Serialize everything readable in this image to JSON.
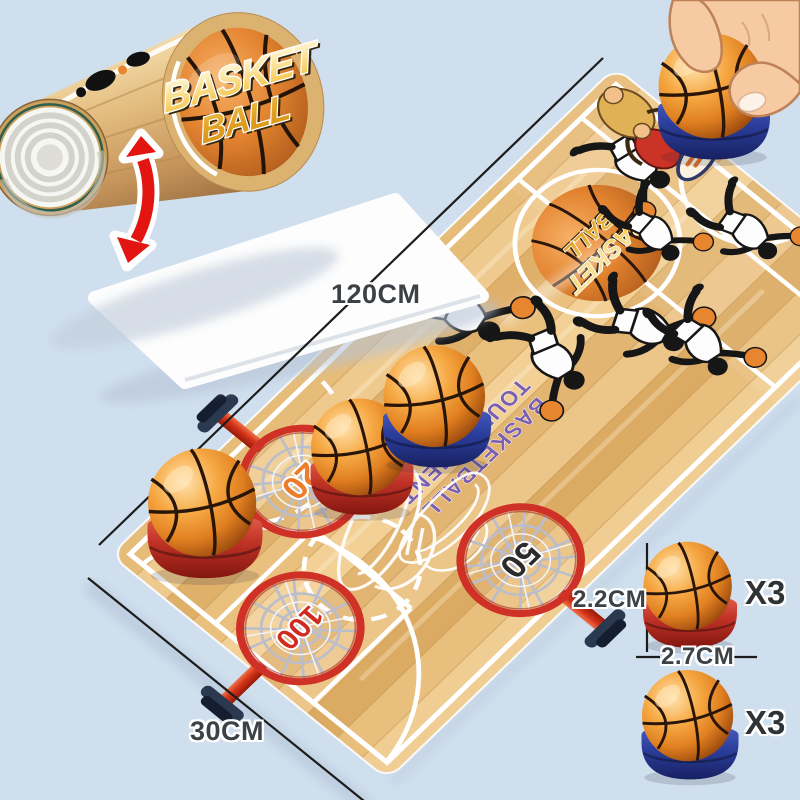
{
  "product_name": "basketball tabletop flick game mat",
  "rolled_mat": {
    "logo_line1": "BASKET",
    "logo_line2": "BALL"
  },
  "court": {
    "center_logo_line1": "BASKET",
    "center_logo_line2": "BALL",
    "tagline_line1": "BASKETBALL",
    "tagline_line2": "TOURNAMENT",
    "hoops": [
      {
        "points": "20",
        "number_color": "#ed7d2a"
      },
      {
        "points": "50",
        "number_color": "#2b2b2b"
      },
      {
        "points": "100",
        "number_color": "#d02b20"
      }
    ]
  },
  "dimensions": {
    "mat_length": "120CM",
    "mat_width": "30CM"
  },
  "specs": {
    "ball_height": "2.2CM",
    "ball_diameter": "2.7CM",
    "balls": [
      {
        "color_name": "orange-red",
        "base_color": "#c23327",
        "qty": "X3"
      },
      {
        "color_name": "blue",
        "base_color": "#2c3f9e",
        "qty": "X3"
      }
    ]
  },
  "colors": {
    "background": "#cfdfee",
    "court_wood": "#e9c286",
    "court_lines": "#ffffff",
    "hoop_ring_red": "#cf3126",
    "basketball_orange": "#ef9330",
    "tagline_purple": "#7c5fad",
    "logo_gold": "#f6cd5d",
    "dimension_text": "#3c4146",
    "arrow_red": "#e21511",
    "hand_skin": "#f6cba4"
  }
}
